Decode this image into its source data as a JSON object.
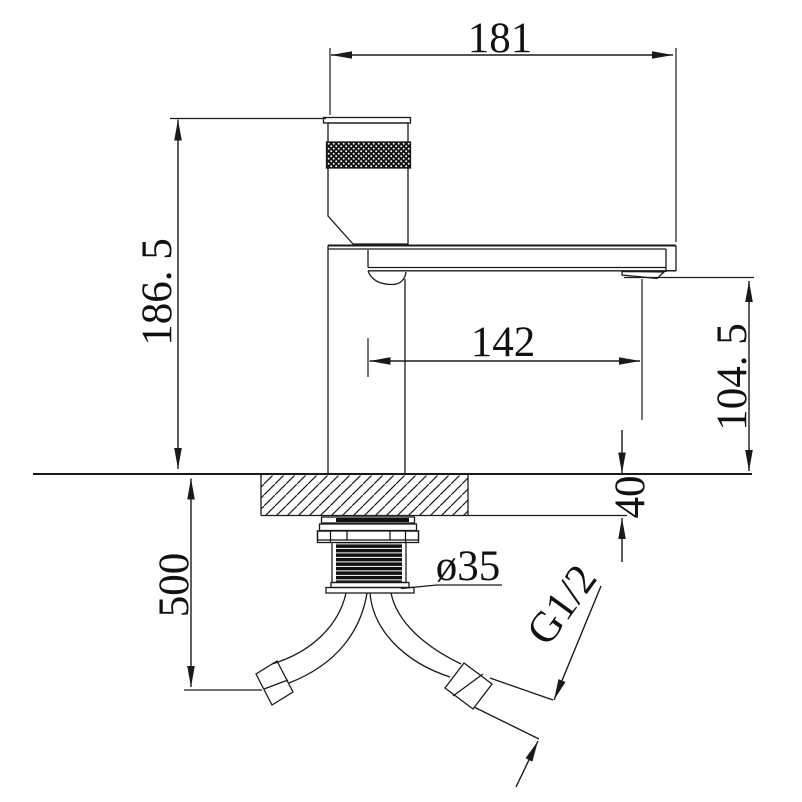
{
  "drawing": {
    "background": "#ffffff",
    "line_color": "#1a1a1a",
    "type": "faucet-dimension-drawing"
  },
  "dims": {
    "overall_width": {
      "value": "181"
    },
    "total_height": {
      "value": "186. 5"
    },
    "spout_reach": {
      "value": "142"
    },
    "spout_outlet_height": {
      "value": "104. 5"
    },
    "deck_thickness": {
      "value": "40"
    },
    "hose_length": {
      "value": "500"
    },
    "hole_diameter": {
      "value": "ø35"
    },
    "thread_size": {
      "value": "G1/2"
    }
  }
}
